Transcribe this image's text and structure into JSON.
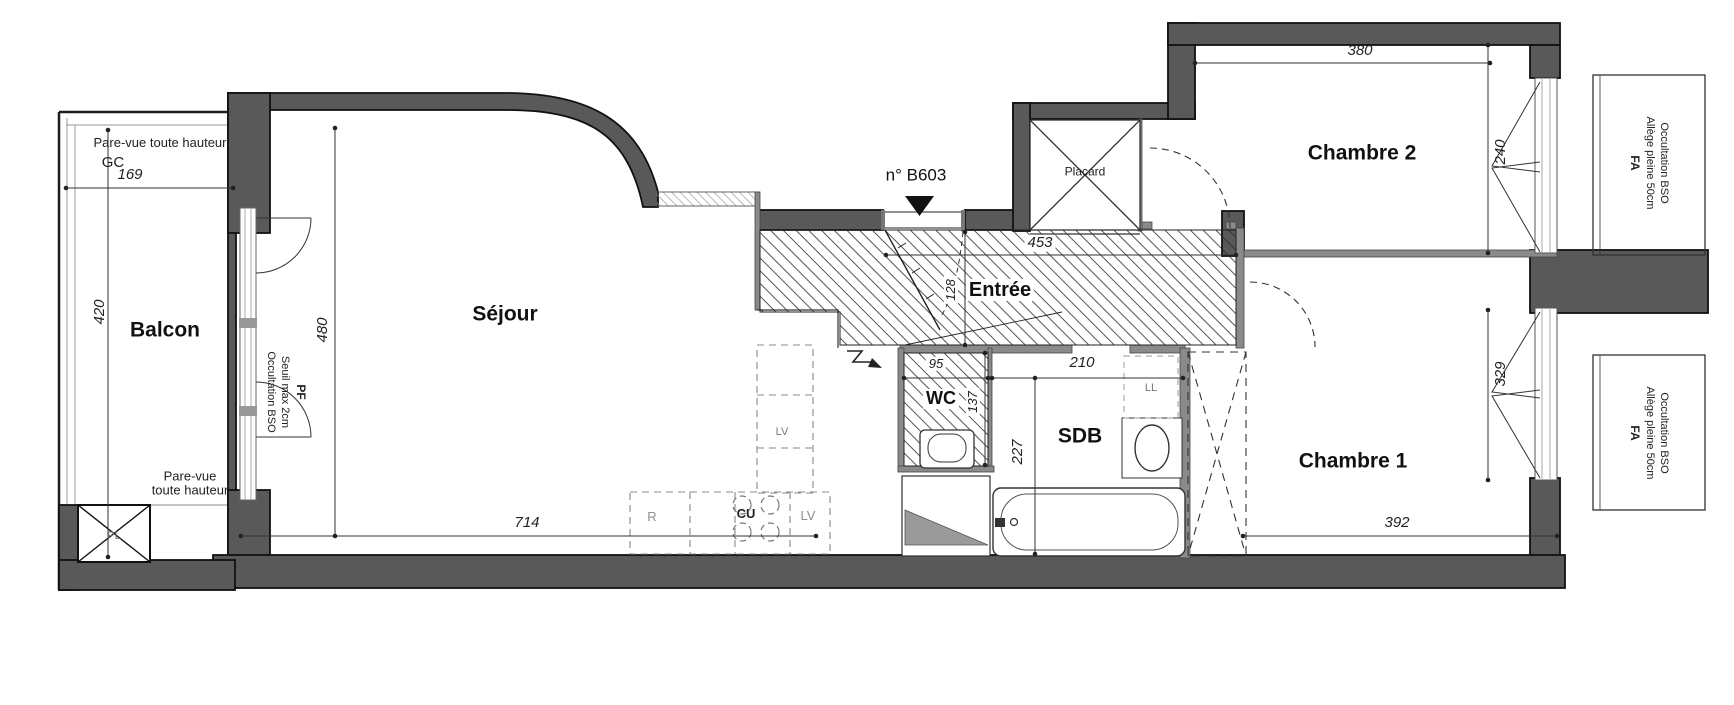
{
  "unit": {
    "label": "n° B603"
  },
  "rooms": {
    "balcon": "Balcon",
    "sejour": "Séjour",
    "entree": "Entrée",
    "wc": "WC",
    "sdb": "SDB",
    "chambre1": "Chambre 1",
    "chambre2": "Chambre 2",
    "placard": "Placard"
  },
  "dimensions_cm": {
    "balcon_width": "169",
    "balcon_depth": "420",
    "sejour_depth": "480",
    "sejour_width": "714",
    "entree_width": "453",
    "entree_depth": "128",
    "wc_width": "95",
    "wc_depth": "137",
    "sdb_width": "210",
    "sdb_depth": "227",
    "chambre2_width": "380",
    "chambre2_window": "240",
    "chambre1_width": "392",
    "chambre1_window": "329"
  },
  "labels": {
    "gc": "GC",
    "pl": "PL",
    "ll": "LL",
    "lv_tall": "LV",
    "fridge": "R",
    "cooktop": "CU",
    "dishwasher": "LV",
    "pare_vue_top": "Pare-vue toute hauteur",
    "pare_vue_bottom_line1": "Pare-vue",
    "pare_vue_bottom_line2": "toute hauteur"
  },
  "window_notes": {
    "pf": {
      "line1": "PF",
      "line2": "Seuil max  2cm",
      "line3": "Occultation  BSO"
    },
    "fa": {
      "line1": "FA",
      "line2": "Allège pleine  50cm",
      "line3": "Occultation   BSO"
    }
  },
  "colors": {
    "wall": "#595959",
    "line": "#1d1d1d",
    "muted": "#8f8f8f",
    "paper": "#ffffff"
  }
}
